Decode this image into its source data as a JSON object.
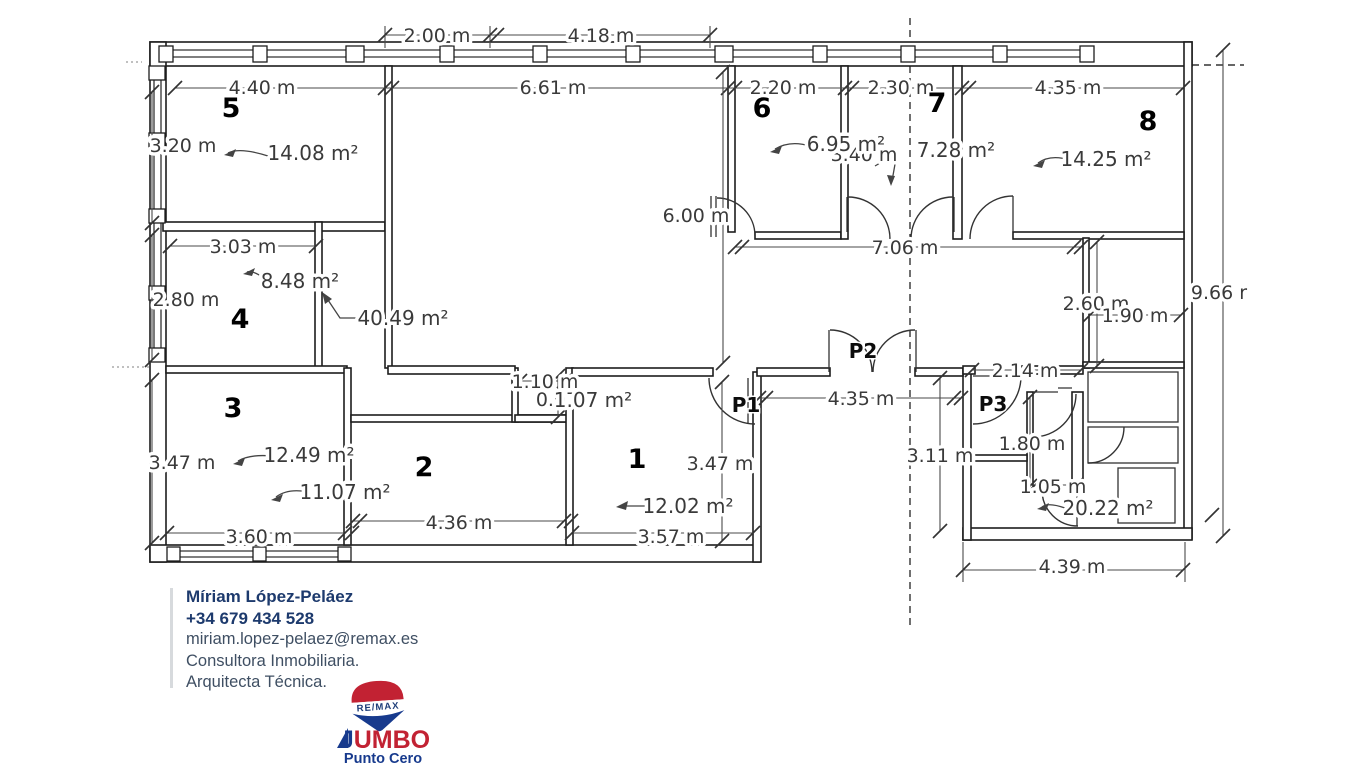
{
  "plan": {
    "dimensions": [
      "2.00 m",
      "4.18 m",
      "4.40 m",
      "6.61 m",
      "2.20 m",
      "2.30 m",
      "4.35 m",
      "3.20 m",
      "3.40 m",
      "6.00 m",
      "3.03 m",
      "7.06 m",
      "2.80 m",
      "2.60 m",
      "1.90 m",
      "9.66 r",
      "2.14 m",
      "1.10 m",
      "0.97",
      "4.35 m",
      "1.80 m",
      "3.11 m",
      "3.47 m",
      "3.47 m",
      "1.05 m",
      "4.36 m",
      "3.60 m",
      "3.57 m",
      "4.39 m"
    ],
    "areas": [
      "14.08 m²",
      "6.95 m²",
      "7.28 m²",
      "14.25 m²",
      "8.48 m²",
      "40.49 m²",
      "1.07 m²",
      "12.49 m²",
      "11.07 m²",
      "12.02 m²",
      "20.22 m²"
    ],
    "room_numbers": [
      "1",
      "2",
      "3",
      "4",
      "5",
      "6",
      "7",
      "8"
    ],
    "door_labels": [
      "P1",
      "P2",
      "P3"
    ]
  },
  "contact": {
    "name": "Míriam López-Peláez",
    "phone": "+34 679 434 528",
    "email": "miriam.lopez-pelaez@remax.es",
    "line1": "Consultora Inmobiliaria.",
    "line2": "Arquitecta Técnica."
  },
  "logo": {
    "brand": "RE/MAX",
    "name_j": "J",
    "name_rest": "UMBO",
    "tagline": "Punto Cero",
    "red": "#c22233",
    "blue": "#173a8d",
    "navy": "#1c3c78"
  }
}
